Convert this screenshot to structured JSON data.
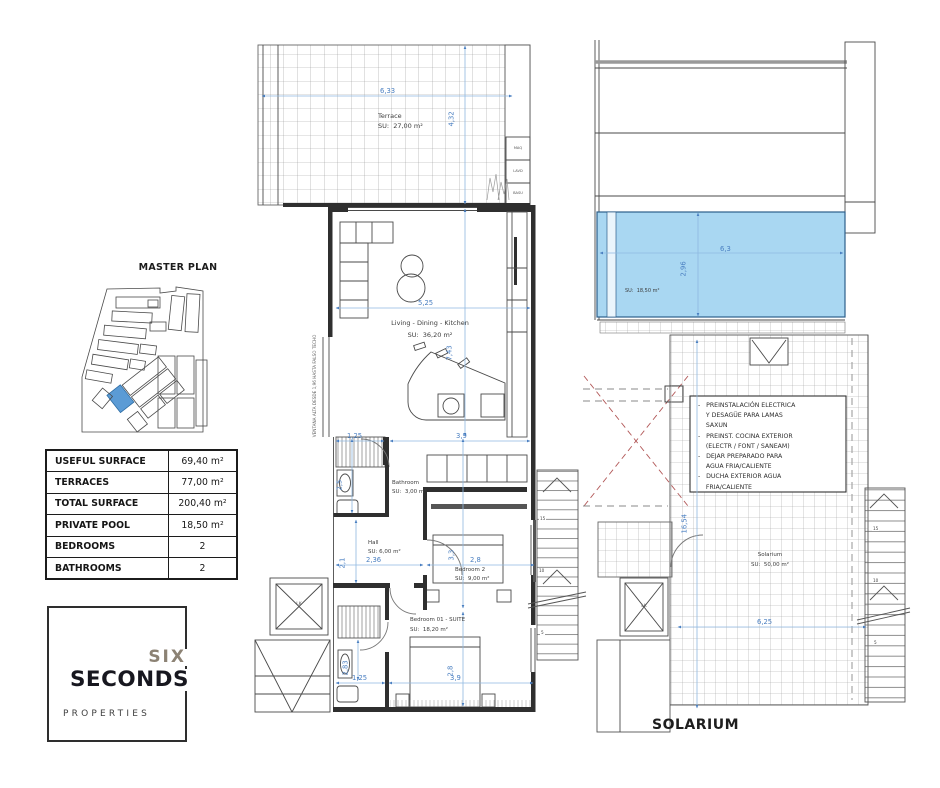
{
  "left": {
    "master_plan_title": "MASTER PLAN",
    "table": {
      "rows": [
        {
          "label": "USEFUL SURFACE",
          "value": "69,40 m²"
        },
        {
          "label": "TERRACES",
          "value": "77,00 m²"
        },
        {
          "label": "TOTAL SURFACE",
          "value": "200,40 m²"
        },
        {
          "label": "PRIVATE POOL",
          "value": "18,50 m²"
        },
        {
          "label": "BEDROOMS",
          "value": "2"
        },
        {
          "label": "BATHROOMS",
          "value": "2"
        }
      ]
    },
    "logo": {
      "six": "SIX",
      "seconds": "SECONDS",
      "properties": "PROPERTIES"
    }
  },
  "main": {
    "terrace": {
      "name": "Terrace",
      "su": "SU:  27,00 m²",
      "dw": "6,33",
      "dh": "4,32"
    },
    "utilities": [
      "MAQ",
      "LAVD",
      "BASU"
    ],
    "living": {
      "name": "Living - Dining - Kitchen",
      "su": "SU:  36,20 m²",
      "dw": "5,25",
      "dh": "7,43"
    },
    "bath": {
      "name": "Bathroom",
      "su": "SU:  3,00 m²",
      "dh": "2,5",
      "dw": "1,25"
    },
    "hall": {
      "name": "Hall",
      "su": "SU: 6,00 m²",
      "dw": "2,36",
      "dh": "2,1"
    },
    "bed2": {
      "name": "Bedroom 2",
      "su": "SU:  9,00 m²",
      "dw": "2,8",
      "dh": "3,3",
      "dtop": "3,9"
    },
    "suite": {
      "name": "Bedroom 01 - SUITE",
      "su": "SU:  18,20 m²",
      "dh1": "2,83",
      "dw1": "1,25",
      "dw2": "3,9",
      "dh2": "2,8"
    },
    "window_note": "VENTANA ALTA DESDE 1,96 HASTA FALSO TECHO",
    "lift": "LK",
    "stairs": [
      "15",
      "10",
      "5"
    ]
  },
  "sol": {
    "pool": {
      "su": "SU:  18,50 m²",
      "dw": "6,3",
      "dh": "2,96"
    },
    "notes": [
      "-   PREINSTALACIÓN ELECTRICA",
      "    Y DESAGÜE PARA LAMAS",
      "    SAXUN",
      "-   PREINST. COCINA EXTERIOR",
      "    (ELECTR / FONT / SANEAM)",
      "-   DEJAR PREPARADO PARA",
      "    AGUA FRIA/CALIENTE",
      "-   DUCHA EXTERIOR AGUA",
      "    FRIA/CALIENTE"
    ],
    "solarium": {
      "name": "Solarium",
      "su": "SU:  50,00 m²",
      "dw": "6,25",
      "dh": "16,54"
    },
    "lift": "LK",
    "stairs": [
      "15",
      "10",
      "5"
    ],
    "caption": "SOLARIUM"
  },
  "colors": {
    "pool": "#a9d7f2",
    "dimension": "#4a7fc1",
    "void_cross": "#b25858",
    "highlight_plot": "#5b9bd5"
  }
}
